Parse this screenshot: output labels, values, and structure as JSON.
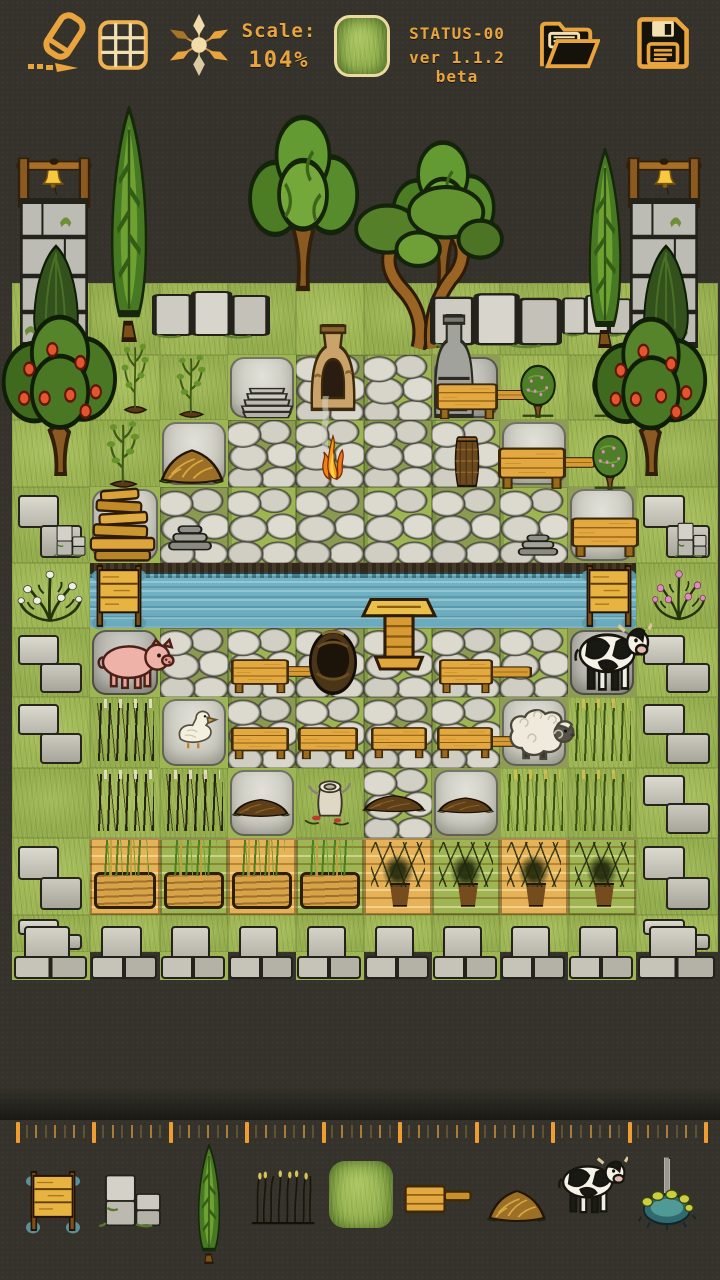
{
  "app": {
    "bg_color": "#34322a",
    "accent_color": "#e9a43e"
  },
  "toolbar": {
    "scale_label": "Scale:",
    "scale_value": "104%",
    "status_line1": "STATUS-00",
    "status_line2": "ver 1.1.2 beta",
    "current_tile": "grass-tile",
    "buttons": [
      "eraser",
      "grid",
      "compass",
      "open-folder",
      "save"
    ]
  },
  "map": {
    "col_bounds": [
      12,
      90,
      160,
      228,
      296,
      364,
      432,
      500,
      568,
      636,
      718
    ],
    "row_bounds": [
      96,
      158,
      220,
      283,
      355,
      420,
      487,
      563,
      628,
      697,
      768,
      838,
      915,
      952,
      980
    ],
    "legend": {
      "E": "empty",
      "G": "grass",
      "C": "cobblestone",
      "S": "stone-slab",
      "D": "dark-slab",
      "W": "water",
      "B": "stone-blocks",
      "M": "stone-wall-row",
      "K": "dark-reeds",
      "T": "green-reeds",
      "P": "planter-wheat",
      "Q": "planter-potted-plant"
    },
    "grid": [
      "EEEEEEEEEE",
      "EEEEEEEEEE",
      "EEEEEEEEEE",
      "GGGGGGGGGG",
      "GGGSCCDGGG",
      "GGSCCCCSGG",
      "BSCCCCCCSB",
      "GWWWWWWWWG",
      "BDCCCCCCDB",
      "BKSCCCCSTB",
      "GKKSGCSTTB",
      "BPPPPQQQQB",
      "BGGGGGGGGB",
      "MMMMMMMMMM"
    ],
    "sprites": [
      {
        "type": "bell",
        "name": "bell-left",
        "x": 38,
        "y": 162,
        "w": 30,
        "h": 34
      },
      {
        "type": "bell",
        "name": "bell-right",
        "x": 650,
        "y": 162,
        "w": 30,
        "h": 34
      },
      {
        "type": "bellframe",
        "name": "bell-frame-left",
        "x": 16,
        "y": 154,
        "w": 76,
        "h": 54
      },
      {
        "type": "bellframe",
        "name": "bell-frame-right",
        "x": 626,
        "y": 154,
        "w": 76,
        "h": 54
      },
      {
        "type": "cypress",
        "name": "cypress-tree-left",
        "x": 88,
        "y": 106,
        "w": 82,
        "h": 236
      },
      {
        "type": "cypress",
        "name": "cypress-tree-right",
        "x": 568,
        "y": 148,
        "w": 74,
        "h": 200
      },
      {
        "type": "oak",
        "name": "oak-tree-1",
        "x": 240,
        "y": 112,
        "w": 126,
        "h": 180
      },
      {
        "type": "oak",
        "name": "oak-tree-2",
        "x": 384,
        "y": 138,
        "w": 118,
        "h": 152
      },
      {
        "type": "olive",
        "name": "olive-tree",
        "x": 350,
        "y": 182,
        "w": 155,
        "h": 168
      },
      {
        "type": "tower",
        "name": "bell-tower-left",
        "x": 20,
        "y": 198,
        "w": 68,
        "h": 150
      },
      {
        "type": "tower",
        "name": "bell-tower-right",
        "x": 630,
        "y": 198,
        "w": 68,
        "h": 150
      },
      {
        "type": "bush",
        "name": "tower-bush-left",
        "x": 24,
        "y": 244,
        "w": 64,
        "h": 106
      },
      {
        "type": "bush",
        "name": "tower-bush-right",
        "x": 634,
        "y": 244,
        "w": 64,
        "h": 106
      },
      {
        "type": "wall",
        "name": "stone-wall-a",
        "x": 152,
        "y": 290,
        "w": 118,
        "h": 50
      },
      {
        "type": "wall",
        "name": "stone-wall-b",
        "x": 430,
        "y": 292,
        "w": 132,
        "h": 58
      },
      {
        "type": "wall",
        "name": "stone-wall-c",
        "x": 562,
        "y": 294,
        "w": 70,
        "h": 44
      },
      {
        "type": "apple",
        "name": "apple-tree-left",
        "x": -4,
        "y": 314,
        "w": 128,
        "h": 162
      },
      {
        "type": "apple",
        "name": "apple-tree-right",
        "x": 588,
        "y": 316,
        "w": 126,
        "h": 160
      },
      {
        "type": "tomato",
        "name": "tomato-plant-1",
        "x": 110,
        "y": 338,
        "w": 50,
        "h": 78
      },
      {
        "type": "tomato",
        "name": "tomato-plant-2",
        "x": 164,
        "y": 350,
        "w": 54,
        "h": 70
      },
      {
        "type": "tomato",
        "name": "tomato-plant-3",
        "x": 93,
        "y": 416,
        "w": 60,
        "h": 74
      },
      {
        "type": "plates",
        "name": "stone-plates-stack",
        "x": 234,
        "y": 378,
        "w": 66,
        "h": 44
      },
      {
        "type": "kiln",
        "name": "clay-kiln",
        "x": 302,
        "y": 324,
        "w": 62,
        "h": 88
      },
      {
        "type": "smoke",
        "name": "kiln-smoke",
        "x": 310,
        "y": 396,
        "w": 32,
        "h": 52
      },
      {
        "type": "fire",
        "name": "camp-fire",
        "x": 312,
        "y": 432,
        "w": 42,
        "h": 50
      },
      {
        "type": "chimney",
        "name": "stone-furnace",
        "x": 428,
        "y": 314,
        "w": 52,
        "h": 104
      },
      {
        "type": "table",
        "name": "table-a",
        "x": 436,
        "y": 382,
        "w": 62,
        "h": 38
      },
      {
        "type": "plank",
        "name": "plank-a",
        "x": 494,
        "y": 388,
        "w": 32,
        "h": 14
      },
      {
        "type": "fruitball",
        "name": "fruit-tree-1",
        "x": 514,
        "y": 362,
        "w": 48,
        "h": 56
      },
      {
        "type": "fruitball",
        "name": "fruit-tree-2",
        "x": 586,
        "y": 362,
        "w": 48,
        "h": 56
      },
      {
        "type": "fruitball",
        "name": "fruit-tree-3",
        "x": 586,
        "y": 432,
        "w": 48,
        "h": 58
      },
      {
        "type": "hay",
        "name": "hay-pile",
        "x": 158,
        "y": 432,
        "w": 68,
        "h": 54
      },
      {
        "type": "basket",
        "name": "tall-basket",
        "x": 448,
        "y": 436,
        "w": 38,
        "h": 52
      },
      {
        "type": "table",
        "name": "table-b",
        "x": 498,
        "y": 446,
        "w": 68,
        "h": 44
      },
      {
        "type": "plank",
        "name": "plank-b",
        "x": 562,
        "y": 455,
        "w": 33,
        "h": 15
      },
      {
        "type": "woodpile",
        "name": "wood-pile",
        "x": 88,
        "y": 482,
        "w": 72,
        "h": 80
      },
      {
        "type": "flatstones",
        "name": "flat-stones-1",
        "x": 164,
        "y": 520,
        "w": 52,
        "h": 38
      },
      {
        "type": "flatstones",
        "name": "flat-stones-2",
        "x": 514,
        "y": 530,
        "w": 48,
        "h": 32
      },
      {
        "type": "table",
        "name": "table-wide",
        "x": 571,
        "y": 516,
        "w": 68,
        "h": 42
      },
      {
        "type": "blocks",
        "name": "blocks-small-left",
        "x": 53,
        "y": 524,
        "w": 34,
        "h": 34
      },
      {
        "type": "blocks",
        "name": "blocks-small-right",
        "x": 674,
        "y": 521,
        "w": 34,
        "h": 38
      },
      {
        "type": "rosebushw",
        "name": "rose-bush-white",
        "x": 10,
        "y": 556,
        "w": 80,
        "h": 72
      },
      {
        "type": "rosebushp",
        "name": "rose-bush-pink",
        "x": 646,
        "y": 556,
        "w": 66,
        "h": 70
      },
      {
        "type": "gate",
        "name": "water-gate-left",
        "x": 92,
        "y": 562,
        "w": 54,
        "h": 68
      },
      {
        "type": "gate",
        "name": "water-gate-right",
        "x": 582,
        "y": 562,
        "w": 54,
        "h": 68
      },
      {
        "type": "watertable",
        "name": "water-pedestal-table",
        "x": 360,
        "y": 598,
        "w": 78,
        "h": 74
      },
      {
        "type": "pig",
        "name": "pig",
        "x": 95,
        "y": 634,
        "w": 80,
        "h": 58
      },
      {
        "type": "cow",
        "name": "cow",
        "x": 572,
        "y": 620,
        "w": 80,
        "h": 74
      },
      {
        "type": "well",
        "name": "round-pot-well",
        "x": 306,
        "y": 626,
        "w": 54,
        "h": 70
      },
      {
        "type": "table",
        "name": "table-c",
        "x": 231,
        "y": 658,
        "w": 58,
        "h": 36
      },
      {
        "type": "plank",
        "name": "plank-c",
        "x": 285,
        "y": 664,
        "w": 28,
        "h": 15
      },
      {
        "type": "table",
        "name": "table-d",
        "x": 439,
        "y": 658,
        "w": 54,
        "h": 36
      },
      {
        "type": "plank",
        "name": "plank-d",
        "x": 488,
        "y": 664,
        "w": 44,
        "h": 16
      },
      {
        "type": "duck",
        "name": "duck",
        "x": 168,
        "y": 704,
        "w": 56,
        "h": 56
      },
      {
        "type": "sheep",
        "name": "sheep",
        "x": 500,
        "y": 700,
        "w": 78,
        "h": 62
      },
      {
        "type": "table",
        "name": "table-e",
        "x": 231,
        "y": 726,
        "w": 58,
        "h": 34
      },
      {
        "type": "table",
        "name": "table-f",
        "x": 298,
        "y": 726,
        "w": 60,
        "h": 34
      },
      {
        "type": "table",
        "name": "table-g",
        "x": 371,
        "y": 726,
        "w": 56,
        "h": 33
      },
      {
        "type": "table",
        "name": "table-h",
        "x": 437,
        "y": 726,
        "w": 56,
        "h": 33
      },
      {
        "type": "plank",
        "name": "plank-h",
        "x": 488,
        "y": 734,
        "w": 42,
        "h": 15
      },
      {
        "type": "mound",
        "name": "dirt-mound-1",
        "x": 231,
        "y": 786,
        "w": 60,
        "h": 34
      },
      {
        "type": "stump",
        "name": "stump-with-bones",
        "x": 299,
        "y": 770,
        "w": 62,
        "h": 60
      },
      {
        "type": "mound",
        "name": "dirt-mound-2",
        "x": 361,
        "y": 783,
        "w": 66,
        "h": 32
      },
      {
        "type": "mound",
        "name": "dirt-mound-3",
        "x": 436,
        "y": 786,
        "w": 59,
        "h": 30
      }
    ]
  },
  "ruler": {
    "start": 16,
    "minor_step": 9.56,
    "segments": 72,
    "minors_per_major": 8
  },
  "palette": {
    "selected": "grass-tile",
    "items": [
      {
        "type": "gate",
        "name": "water-gate",
        "x": 26,
        "y": 1168,
        "w": 54,
        "h": 66,
        "selected": false
      },
      {
        "type": "blocks",
        "name": "stone-blocks",
        "x": 98,
        "y": 1172,
        "w": 66,
        "h": 58,
        "selected": false
      },
      {
        "type": "cypress",
        "name": "cypress-tree",
        "x": 184,
        "y": 1144,
        "w": 50,
        "h": 120,
        "selected": false
      },
      {
        "type": "reeds",
        "name": "dark-reeds",
        "x": 249,
        "y": 1168,
        "w": 68,
        "h": 58,
        "selected": false
      },
      {
        "type": "grasstile",
        "name": "grass-tile",
        "x": 329,
        "y": 1161,
        "w": 64,
        "h": 67,
        "selected": true
      },
      {
        "type": "tableplank",
        "name": "table-with-plank",
        "x": 404,
        "y": 1182,
        "w": 68,
        "h": 34,
        "selected": false
      },
      {
        "type": "hay",
        "name": "hay-mound",
        "x": 486,
        "y": 1174,
        "w": 62,
        "h": 50,
        "selected": false
      },
      {
        "type": "cow",
        "name": "cow",
        "x": 556,
        "y": 1154,
        "w": 72,
        "h": 62,
        "selected": false
      },
      {
        "type": "fountain",
        "name": "fountain",
        "x": 638,
        "y": 1156,
        "w": 58,
        "h": 74,
        "selected": false
      }
    ]
  }
}
